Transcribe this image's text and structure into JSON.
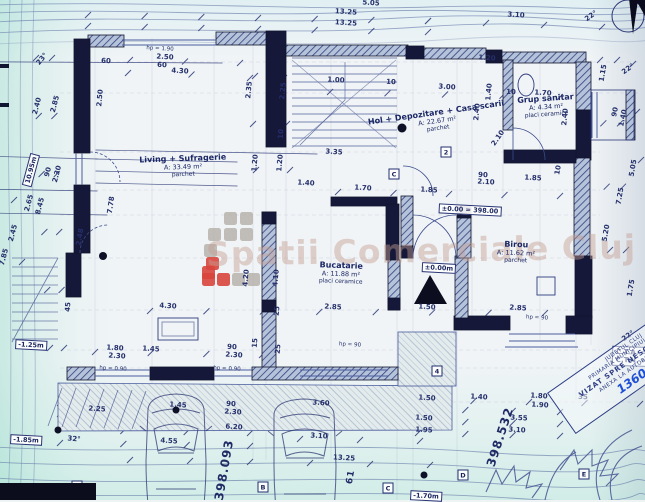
{
  "watermark": {
    "text": "Spatii Comerciale Cluj",
    "gray": "#b7b1ab",
    "red": "#d8453c",
    "logo_squares": [
      {
        "x": 224,
        "y": 212,
        "c": "gray"
      },
      {
        "x": 240,
        "y": 212,
        "c": "gray"
      },
      {
        "x": 208,
        "y": 228,
        "c": "gray"
      },
      {
        "x": 224,
        "y": 228,
        "c": "gray"
      },
      {
        "x": 240,
        "y": 228,
        "c": "gray"
      },
      {
        "x": 204,
        "y": 244,
        "c": "gray"
      },
      {
        "x": 206,
        "y": 257,
        "c": "red"
      },
      {
        "x": 202,
        "y": 266,
        "c": "red"
      },
      {
        "x": 202,
        "y": 273,
        "c": "red"
      },
      {
        "x": 217,
        "y": 273,
        "c": "red"
      },
      {
        "x": 232,
        "y": 273,
        "c": "gray"
      },
      {
        "x": 247,
        "y": 273,
        "c": "gray"
      }
    ]
  },
  "rooms": [
    {
      "name": "Living + Sufragerie",
      "area": "A: 33.49 m²",
      "floor": "parchet",
      "x": 183,
      "y": 166,
      "r": -2
    },
    {
      "name": "Hol + Depozitare + Casa scarii",
      "area": "A: 22.67 m²",
      "floor": "parchet",
      "x": 437,
      "y": 120,
      "r": -8
    },
    {
      "name": "Grup sanitar",
      "area": "A: 4.34 m²",
      "floor": "placi ceramice",
      "x": 546,
      "y": 106,
      "r": -4
    },
    {
      "name": "Bucatarie",
      "area": "A: 11.88 m²",
      "floor": "placi ceramice",
      "x": 341,
      "y": 273,
      "r": 2
    },
    {
      "name": "Birou",
      "area": "A: 11.62 m²",
      "floor": "parchet",
      "x": 516,
      "y": 252,
      "r": 2
    }
  ],
  "levels": [
    {
      "t": "±0.00 = 398.00",
      "x": 470,
      "y": 210,
      "r": 3
    },
    {
      "t": "±0.00m",
      "x": 439,
      "y": 268,
      "r": 3
    },
    {
      "t": "-1.25m",
      "x": 31,
      "y": 345,
      "r": 3
    },
    {
      "t": "-1.85m",
      "x": 26,
      "y": 440,
      "r": 3
    },
    {
      "t": "-1.70m",
      "x": 426,
      "y": 496,
      "r": 3
    },
    {
      "t": "10.95m",
      "x": 31,
      "y": 170,
      "r": -75
    }
  ],
  "elevations": [
    {
      "t": "398.093",
      "x": 224,
      "y": 470,
      "r": -80,
      "sz": "lg"
    },
    {
      "t": "398.532",
      "x": 500,
      "y": 437,
      "r": -72,
      "sz": "lg"
    },
    {
      "t": "61",
      "x": 351,
      "y": 477,
      "r": -80,
      "sz": "sm"
    }
  ],
  "markers": [
    {
      "t": "2",
      "x": 446,
      "y": 152
    },
    {
      "t": "C",
      "x": 394,
      "y": 174
    },
    {
      "t": "4",
      "x": 437,
      "y": 371
    },
    {
      "t": "A",
      "x": 77,
      "y": 486
    },
    {
      "t": "B",
      "x": 263,
      "y": 487
    },
    {
      "t": "C",
      "x": 388,
      "y": 488
    },
    {
      "t": "D",
      "x": 463,
      "y": 475
    },
    {
      "t": "E",
      "x": 584,
      "y": 474
    }
  ],
  "stamp": {
    "lines": [
      "JUDETUL CLUJ",
      "PRIMARIA MUNICIPIULUI CLUJ",
      "VIZAT SPRE NESCHIMBARE",
      "ANEXA LA AUTORIZATIA NR.",
      "1360 din"
    ]
  },
  "cta": {
    "line1": "C.T.A. = 3",
    "line2": "C.T.N. = 3"
  },
  "dims": [
    {
      "t": "5.05",
      "x": 371,
      "y": 3,
      "r": 4
    },
    {
      "t": "13.25",
      "x": 346,
      "y": 12,
      "r": 4
    },
    {
      "t": "13.25",
      "x": 346,
      "y": 23,
      "r": 4
    },
    {
      "t": "3.10",
      "x": 516,
      "y": 15,
      "r": 4
    },
    {
      "t": "22°",
      "x": 591,
      "y": 16,
      "r": -35
    },
    {
      "t": "hp = 1.90",
      "x": 160,
      "y": 49,
      "r": 3
    },
    {
      "t": "2.50",
      "x": 165,
      "y": 57,
      "r": 3
    },
    {
      "t": "60",
      "x": 162,
      "y": 65,
      "r": 3
    },
    {
      "t": "4.30",
      "x": 180,
      "y": 71,
      "r": 3
    },
    {
      "t": "60",
      "x": 106,
      "y": 61,
      "r": 3
    },
    {
      "t": "1.20",
      "x": 487,
      "y": 58,
      "r": 3
    },
    {
      "t": "2.50",
      "x": 100,
      "y": 98,
      "r": -85
    },
    {
      "t": "2.35",
      "x": 249,
      "y": 90,
      "r": -85
    },
    {
      "t": "2.25",
      "x": 283,
      "y": 91,
      "r": -85
    },
    {
      "t": "10",
      "x": 281,
      "y": 134,
      "r": -85
    },
    {
      "t": "2.40",
      "x": 37,
      "y": 106,
      "r": -75
    },
    {
      "t": "2.85",
      "x": 55,
      "y": 104,
      "r": -75
    },
    {
      "t": "23°",
      "x": 42,
      "y": 59,
      "r": -50
    },
    {
      "t": "90",
      "x": 48,
      "y": 172,
      "r": -75
    },
    {
      "t": "2.30",
      "x": 57,
      "y": 174,
      "r": -75
    },
    {
      "t": "2.65",
      "x": 29,
      "y": 203,
      "r": -75
    },
    {
      "t": "8.45",
      "x": 40,
      "y": 206,
      "r": -75
    },
    {
      "t": "2.45",
      "x": 13,
      "y": 233,
      "r": -75
    },
    {
      "t": "2.48",
      "x": 80,
      "y": 237,
      "r": -80
    },
    {
      "t": "7.78",
      "x": 111,
      "y": 205,
      "r": -82
    },
    {
      "t": "7.85",
      "x": 4,
      "y": 257,
      "r": -75
    },
    {
      "t": "1.00",
      "x": 336,
      "y": 80,
      "r": 3
    },
    {
      "t": "10",
      "x": 391,
      "y": 82,
      "r": 3
    },
    {
      "t": "3.00",
      "x": 447,
      "y": 87,
      "r": 3
    },
    {
      "t": "1.40",
      "x": 489,
      "y": 92,
      "r": -85
    },
    {
      "t": "10",
      "x": 511,
      "y": 92,
      "r": 3
    },
    {
      "t": "1.70",
      "x": 543,
      "y": 93,
      "r": 3
    },
    {
      "t": "2.40",
      "x": 477,
      "y": 112,
      "r": -85
    },
    {
      "t": "2.40",
      "x": 565,
      "y": 117,
      "r": -85
    },
    {
      "t": "1.15",
      "x": 603,
      "y": 73,
      "r": -80
    },
    {
      "t": "22°",
      "x": 628,
      "y": 69,
      "r": -35
    },
    {
      "t": "90",
      "x": 615,
      "y": 112,
      "r": -78
    },
    {
      "t": "1.40",
      "x": 623,
      "y": 118,
      "r": -78
    },
    {
      "t": "2.10",
      "x": 498,
      "y": 138,
      "r": -55
    },
    {
      "t": "1.20",
      "x": 255,
      "y": 163,
      "r": -85
    },
    {
      "t": "1.20",
      "x": 280,
      "y": 163,
      "r": -85
    },
    {
      "t": "1.40",
      "x": 306,
      "y": 183,
      "r": 3
    },
    {
      "t": "3.35",
      "x": 334,
      "y": 152,
      "r": 3
    },
    {
      "t": "1.70",
      "x": 363,
      "y": 188,
      "r": 3
    },
    {
      "t": "1.85",
      "x": 429,
      "y": 190,
      "r": 3
    },
    {
      "t": "90",
      "x": 483,
      "y": 175,
      "r": 3
    },
    {
      "t": "2.10",
      "x": 486,
      "y": 182,
      "r": 3
    },
    {
      "t": "1.85",
      "x": 533,
      "y": 178,
      "r": 3
    },
    {
      "t": "10",
      "x": 558,
      "y": 170,
      "r": -80
    },
    {
      "t": "5.05",
      "x": 633,
      "y": 168,
      "r": -80
    },
    {
      "t": "7.25",
      "x": 620,
      "y": 196,
      "r": -80
    },
    {
      "t": "5.20",
      "x": 606,
      "y": 233,
      "r": -80
    },
    {
      "t": "4.20",
      "x": 246,
      "y": 278,
      "r": -85
    },
    {
      "t": "4.10",
      "x": 276,
      "y": 278,
      "r": -85
    },
    {
      "t": "4.30",
      "x": 168,
      "y": 306,
      "r": 3
    },
    {
      "t": "2.85",
      "x": 333,
      "y": 307,
      "r": 3
    },
    {
      "t": "1.50",
      "x": 427,
      "y": 307,
      "r": 3
    },
    {
      "t": "2.85",
      "x": 518,
      "y": 308,
      "r": 3
    },
    {
      "t": "45",
      "x": 68,
      "y": 307,
      "r": -85
    },
    {
      "t": "1.80",
      "x": 115,
      "y": 348,
      "r": 3
    },
    {
      "t": "2.30",
      "x": 117,
      "y": 356,
      "r": 3
    },
    {
      "t": "1.45",
      "x": 151,
      "y": 349,
      "r": 3
    },
    {
      "t": "90",
      "x": 232,
      "y": 347,
      "r": 3
    },
    {
      "t": "2.30",
      "x": 234,
      "y": 355,
      "r": 3
    },
    {
      "t": "15",
      "x": 255,
      "y": 343,
      "r": -85
    },
    {
      "t": "25",
      "x": 277,
      "y": 311,
      "r": -85
    },
    {
      "t": "25",
      "x": 278,
      "y": 349,
      "r": -85
    },
    {
      "t": "hp = 0.90",
      "x": 113,
      "y": 369,
      "r": 3
    },
    {
      "t": "hp = 0.90",
      "x": 227,
      "y": 369,
      "r": 3
    },
    {
      "t": "hp = 90",
      "x": 537,
      "y": 318,
      "r": 3
    },
    {
      "t": "hp = 90",
      "x": 350,
      "y": 345,
      "r": 3
    },
    {
      "t": "1.75",
      "x": 631,
      "y": 288,
      "r": -80
    },
    {
      "t": "22°",
      "x": 628,
      "y": 336,
      "r": -35
    },
    {
      "t": "2.25",
      "x": 97,
      "y": 409,
      "r": 3
    },
    {
      "t": "1.45",
      "x": 178,
      "y": 405,
      "r": 3
    },
    {
      "t": "90",
      "x": 231,
      "y": 404,
      "r": 3
    },
    {
      "t": "2.30",
      "x": 233,
      "y": 412,
      "r": 3
    },
    {
      "t": "6.20",
      "x": 234,
      "y": 427,
      "r": 3
    },
    {
      "t": "32°",
      "x": 74,
      "y": 439,
      "r": 5
    },
    {
      "t": "4.55",
      "x": 169,
      "y": 441,
      "r": 4
    },
    {
      "t": "3.60",
      "x": 321,
      "y": 403,
      "r": 3
    },
    {
      "t": "3.10",
      "x": 319,
      "y": 436,
      "r": 3
    },
    {
      "t": "13.25",
      "x": 344,
      "y": 458,
      "r": 3
    },
    {
      "t": "1.50",
      "x": 427,
      "y": 398,
      "r": 3
    },
    {
      "t": "1.40",
      "x": 479,
      "y": 397,
      "r": 3
    },
    {
      "t": "1.80",
      "x": 539,
      "y": 396,
      "r": 3
    },
    {
      "t": "1.90",
      "x": 540,
      "y": 405,
      "r": 3
    },
    {
      "t": "1.50",
      "x": 424,
      "y": 418,
      "r": 3
    },
    {
      "t": "3.55",
      "x": 519,
      "y": 418,
      "r": 3
    },
    {
      "t": "1.95",
      "x": 424,
      "y": 430,
      "r": 3
    },
    {
      "t": "3.10",
      "x": 517,
      "y": 430,
      "r": 3
    },
    {
      "t": "35",
      "x": 583,
      "y": 397,
      "r": 3
    }
  ]
}
